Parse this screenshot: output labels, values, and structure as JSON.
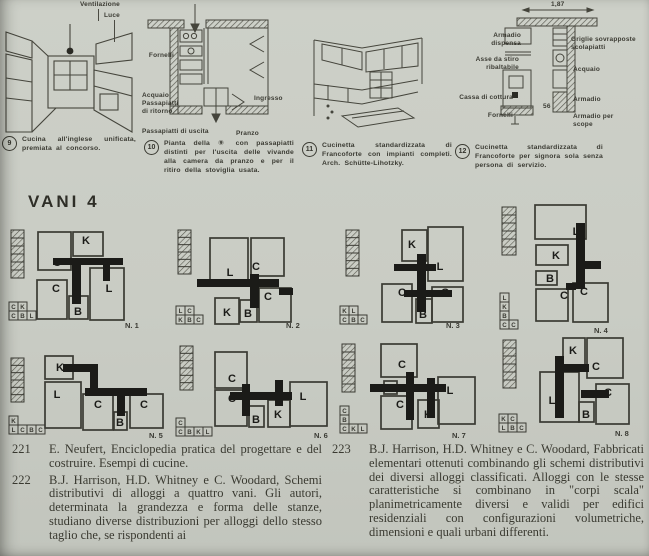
{
  "section": {
    "heading": "VANI 4"
  },
  "figures": [
    {
      "number": "9",
      "caption": "Cucina all'inglese unificata, premiata al concorso.",
      "labels": {
        "ventilazione": "Ventilazione",
        "luce": "Luce"
      }
    },
    {
      "number": "10",
      "caption": "Pianta della ⑨ con passapiatti distinti per l'uscita delle vivande alla camera da pranzo e per il ritiro della stoviglia usata.",
      "labels": {
        "fornelli": "Fornelli",
        "acquaio": "Acquaio",
        "passapiatti_ritorno": "Passapiatti di ritorno",
        "ingresso": "Ingresso",
        "passapiatti_uscita": "Passapiatti di uscita",
        "pranzo": "Pranzo"
      }
    },
    {
      "number": "11",
      "caption": "Cucinetta standardizzata di Francoforte con impianti completi. Arch. Schütte-Lihotzky."
    },
    {
      "number": "12",
      "caption": "Cucinetta standardizzata di Francoforte per signora sola senza persona di servizio.",
      "dimension": "1,87",
      "size_label": "56",
      "labels_left": [
        "Armadio dispensa",
        "Asse da stiro ribaltabile",
        "Cassa di cottura",
        "Fornelli"
      ],
      "labels_right": [
        "Griglie sovrapposte scolapiatti",
        "Acquaio",
        "Armadio",
        "Armadio per scope"
      ]
    }
  ],
  "plans": [
    {
      "caption": "N. 1",
      "rooms": [
        "C",
        "K",
        "L",
        "C",
        "B"
      ],
      "legend": [
        [
          "C",
          "K"
        ],
        [
          "C",
          "B",
          "L"
        ]
      ]
    },
    {
      "caption": "N. 2",
      "rooms": [
        "L",
        "C",
        "K",
        "B",
        "C"
      ],
      "legend": [
        [
          "L",
          "C"
        ],
        [
          "K",
          "B",
          "C"
        ]
      ]
    },
    {
      "caption": "N. 3",
      "rooms": [
        "K",
        "L",
        "C",
        "B",
        "C"
      ],
      "legend": [
        [
          "K",
          "L"
        ],
        [
          "C",
          "B",
          "C"
        ]
      ]
    },
    {
      "caption": "N. 4",
      "rooms": [
        "L",
        "K",
        "B",
        "C",
        "C"
      ],
      "legend": [
        [
          "L"
        ],
        [
          "K"
        ],
        [
          "B"
        ],
        [
          "C",
          "C"
        ]
      ]
    },
    {
      "caption": "N. 5",
      "rooms": [
        "K",
        "L",
        "C",
        "B",
        "C"
      ],
      "legend": [
        [
          "K"
        ],
        [
          "L",
          "C",
          "B",
          "C"
        ]
      ]
    },
    {
      "caption": "N. 6",
      "rooms": [
        "C",
        "C",
        "B",
        "K",
        "L"
      ],
      "legend": [
        [
          "C"
        ],
        [
          "C",
          "B",
          "K",
          "L"
        ]
      ]
    },
    {
      "caption": "N. 7",
      "rooms": [
        "C",
        "B",
        "L",
        "C",
        "K"
      ],
      "legend": [
        [
          "C"
        ],
        [
          "B"
        ],
        [
          "C",
          "K",
          "L"
        ]
      ]
    },
    {
      "caption": "N. 8",
      "rooms": [
        "K",
        "C",
        "L",
        "C",
        "B"
      ],
      "legend": [
        [
          "K",
          "C"
        ],
        [
          "L",
          "B",
          "C"
        ]
      ]
    }
  ],
  "bibliography": {
    "left": [
      {
        "number": "221",
        "text": "E. Neufert, Enciclopedia pratica del progettare e del costruire. Esempi di cucine."
      },
      {
        "number": "222",
        "text": "B.J. Harrison, H.D. Whitney e C. Woodard, Schemi distributivi di alloggi a quattro vani. Gli autori, determinata la grandezza e forma delle stanze, studiano diverse distribuzioni per alloggi dello stesso taglio che, se rispondenti ai"
      }
    ],
    "right": [
      {
        "number": "223",
        "text": "B.J. Harrison, H.D. Whitney e C. Woodard, Fabbricati elementari ottenuti combinando gli schemi distributivi dei diversi alloggi classificati. Alloggi con le stesse caratteristiche si combinano in \"corpi scala\" planimetricamente diversi e validi per edifici residenziali con configurazioni volumetriche, dimensioni e quali urbani differenti."
      }
    ]
  }
}
